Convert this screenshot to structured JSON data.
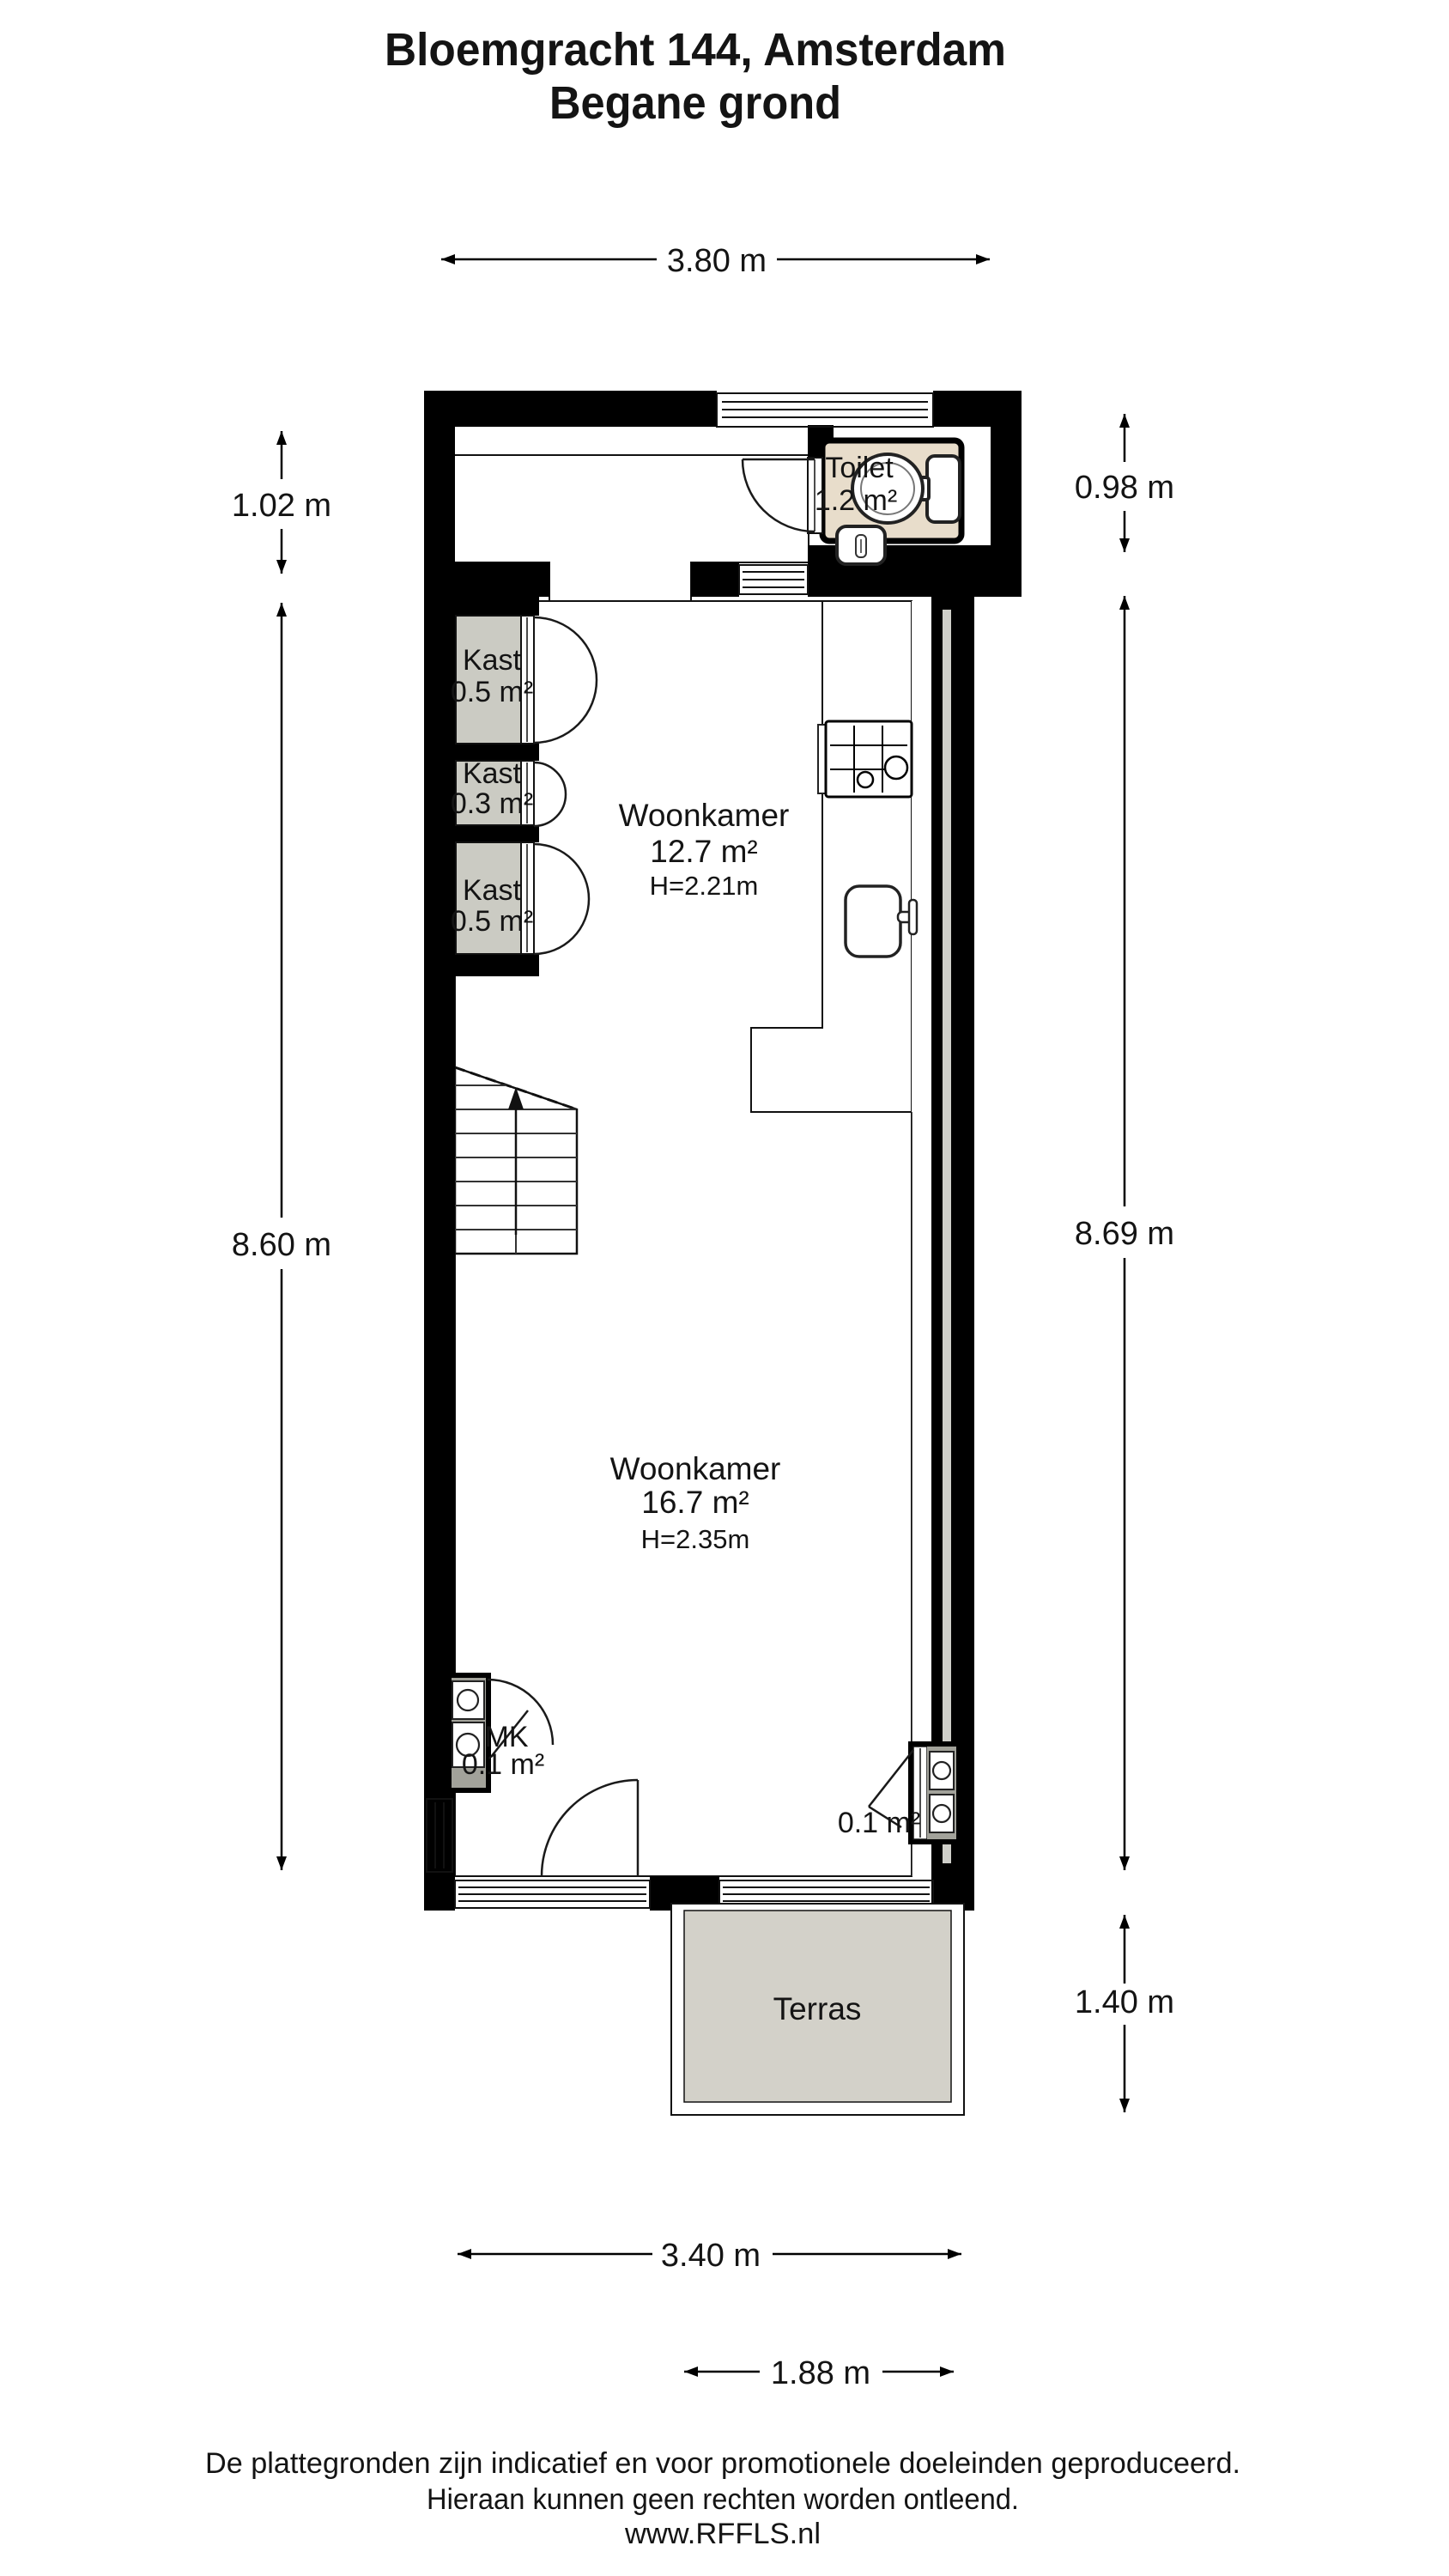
{
  "title": {
    "line1": "Bloemgracht 144, Amsterdam",
    "line2": "Begane grond"
  },
  "dimensions": {
    "top": "3.80 m",
    "left_top": "1.02 m",
    "left_main": "8.60 m",
    "right_top": "0.98 m",
    "right_main": "8.69 m",
    "right_bottom": "1.40 m",
    "bottom_main": "3.40 m",
    "bottom_terras": "1.88 m"
  },
  "rooms": {
    "toilet": {
      "name": "Toilet",
      "area": "1.2 m²"
    },
    "kast1": {
      "name": "Kast",
      "area": "0.5 m²"
    },
    "kast2": {
      "name": "Kast",
      "area": "0.3 m²"
    },
    "kast3": {
      "name": "Kast",
      "area": "0.5 m²"
    },
    "woonkamer_front": {
      "name": "Woonkamer",
      "area": "12.7 m²",
      "ceiling": "H=2.21m"
    },
    "woonkamer_back": {
      "name": "Woonkamer",
      "area": "16.7 m²",
      "ceiling": "H=2.35m"
    },
    "mk": {
      "name": "MK",
      "area": "0.1 m²"
    },
    "meter_closet_right": {
      "area": "0.1 m²"
    },
    "terras": {
      "name": "Terras"
    }
  },
  "footer": {
    "line1": "De plattegronden zijn indicatief en voor promotionele doeleinden geproduceerd.",
    "line2": "Hieraan kunnen geen rechten worden ontleend.",
    "line3": "www.RFFLS.nl"
  },
  "colors": {
    "floor": "#e8ddcb",
    "closet": "#cbcbc3",
    "terras": "#d3d1c9",
    "meter_area": "#a2a29a",
    "wall": "#000000",
    "wall_core": "#cfcfc9"
  }
}
